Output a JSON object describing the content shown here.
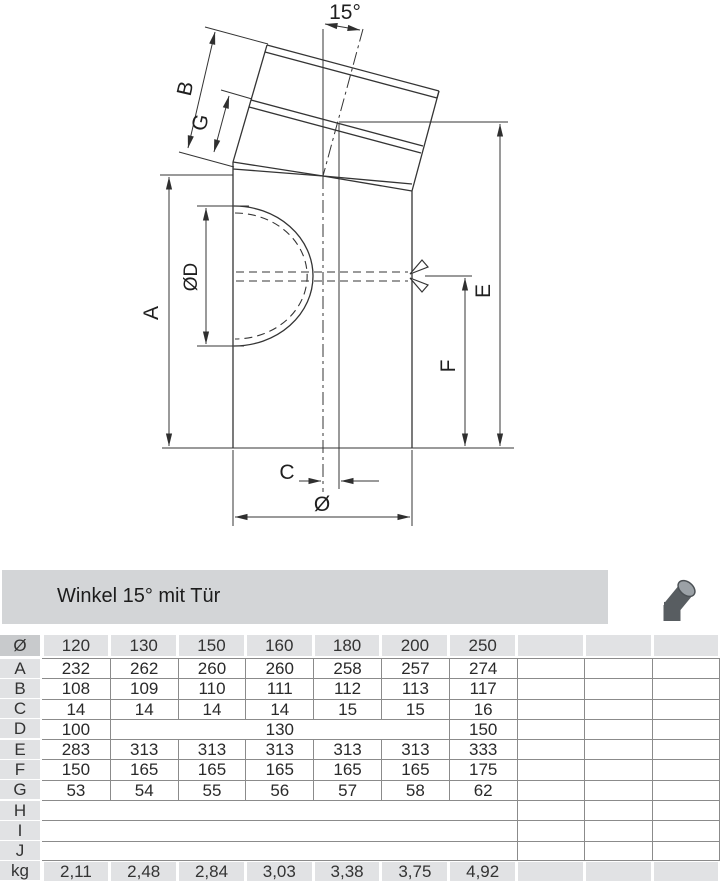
{
  "header": {
    "title": "Winkel 15° mit Tür"
  },
  "drawing": {
    "labels": {
      "angle": "15°",
      "b": "B",
      "g": "G",
      "a": "A",
      "door": "ØD",
      "e": "E",
      "f": "F",
      "c": "C",
      "dia": "Ø"
    }
  },
  "colors": {
    "line": "#343434",
    "bar_bg": "#d3d5d7",
    "chip_bg": "#e1e2e4",
    "chip_dark_bg": "#c8cacc",
    "rule": "#8b8b8b",
    "icon_body": "#585d61",
    "icon_face": "#9ba1a6"
  },
  "table": {
    "rows": [
      {
        "label": "Ø",
        "kind": "gray",
        "dark": 1,
        "cells": [
          {
            "t": "120"
          },
          {
            "t": "130"
          },
          {
            "t": "150"
          },
          {
            "t": "160"
          },
          {
            "t": "180"
          },
          {
            "t": "200"
          },
          {
            "t": "250"
          },
          {
            "t": ""
          },
          {
            "t": ""
          },
          {
            "t": ""
          }
        ]
      },
      {
        "label": "A",
        "kind": "data",
        "cells": [
          {
            "t": "232"
          },
          {
            "t": "262",
            "bl": 1
          },
          {
            "t": "260",
            "bl": 1
          },
          {
            "t": "260",
            "bl": 1
          },
          {
            "t": "258",
            "bl": 1
          },
          {
            "t": "257",
            "bl": 1
          },
          {
            "t": "274",
            "bl": 1
          },
          {
            "t": "",
            "bl": 1
          },
          {
            "t": "",
            "bl": 1
          },
          {
            "t": "",
            "bl": 1,
            "br": 1
          }
        ]
      },
      {
        "label": "B",
        "kind": "data",
        "cells": [
          {
            "t": "108"
          },
          {
            "t": "109",
            "bl": 1
          },
          {
            "t": "110",
            "bl": 1
          },
          {
            "t": "111",
            "bl": 1
          },
          {
            "t": "112",
            "bl": 1
          },
          {
            "t": "113",
            "bl": 1
          },
          {
            "t": "117",
            "bl": 1
          },
          {
            "t": "",
            "bl": 1
          },
          {
            "t": "",
            "bl": 1
          },
          {
            "t": "",
            "bl": 1,
            "br": 1
          }
        ]
      },
      {
        "label": "C",
        "kind": "data",
        "cells": [
          {
            "t": "14"
          },
          {
            "t": "14",
            "bl": 1
          },
          {
            "t": "14",
            "bl": 1
          },
          {
            "t": "14",
            "bl": 1
          },
          {
            "t": "15",
            "bl": 1
          },
          {
            "t": "15",
            "bl": 1
          },
          {
            "t": "16",
            "bl": 1
          },
          {
            "t": "",
            "bl": 1
          },
          {
            "t": "",
            "bl": 1
          },
          {
            "t": "",
            "bl": 1,
            "br": 1
          }
        ]
      },
      {
        "label": "D",
        "kind": "data",
        "cells": [
          {
            "t": "100"
          },
          {
            "t": "130",
            "s": 5,
            "bl": 1
          },
          {
            "t": "150",
            "bl": 1
          },
          {
            "t": "",
            "bl": 1
          },
          {
            "t": "",
            "bl": 1
          },
          {
            "t": "",
            "bl": 1,
            "br": 1
          }
        ]
      },
      {
        "label": "E",
        "kind": "data",
        "cells": [
          {
            "t": "283"
          },
          {
            "t": "313",
            "bl": 1
          },
          {
            "t": "313",
            "bl": 1
          },
          {
            "t": "313",
            "bl": 1
          },
          {
            "t": "313",
            "bl": 1
          },
          {
            "t": "313",
            "bl": 1
          },
          {
            "t": "333",
            "bl": 1
          },
          {
            "t": "",
            "bl": 1
          },
          {
            "t": "",
            "bl": 1
          },
          {
            "t": "",
            "bl": 1,
            "br": 1
          }
        ]
      },
      {
        "label": "F",
        "kind": "data",
        "cells": [
          {
            "t": "150"
          },
          {
            "t": "165",
            "bl": 1
          },
          {
            "t": "165",
            "bl": 1
          },
          {
            "t": "165",
            "bl": 1
          },
          {
            "t": "165",
            "bl": 1
          },
          {
            "t": "165",
            "bl": 1
          },
          {
            "t": "175",
            "bl": 1
          },
          {
            "t": "",
            "bl": 1
          },
          {
            "t": "",
            "bl": 1
          },
          {
            "t": "",
            "bl": 1,
            "br": 1
          }
        ]
      },
      {
        "label": "G",
        "kind": "data",
        "cells": [
          {
            "t": "53"
          },
          {
            "t": "54",
            "bl": 1
          },
          {
            "t": "55",
            "bl": 1
          },
          {
            "t": "56",
            "bl": 1
          },
          {
            "t": "57",
            "bl": 1
          },
          {
            "t": "58",
            "bl": 1
          },
          {
            "t": "62",
            "bl": 1
          },
          {
            "t": "",
            "bl": 1
          },
          {
            "t": "",
            "bl": 1
          },
          {
            "t": "",
            "bl": 1,
            "br": 1
          }
        ]
      },
      {
        "label": "H",
        "kind": "data",
        "cells": [
          {
            "t": "",
            "s": 7
          },
          {
            "t": "",
            "bl": 1
          },
          {
            "t": "",
            "bl": 1
          },
          {
            "t": "",
            "bl": 1,
            "br": 1
          }
        ]
      },
      {
        "label": "I",
        "kind": "data",
        "cells": [
          {
            "t": "",
            "s": 7
          },
          {
            "t": "",
            "bl": 1
          },
          {
            "t": "",
            "bl": 1
          },
          {
            "t": "",
            "bl": 1,
            "br": 1
          }
        ]
      },
      {
        "label": "J",
        "kind": "data",
        "bb": 1,
        "cells": [
          {
            "t": "",
            "s": 7
          },
          {
            "t": "",
            "bl": 1
          },
          {
            "t": "",
            "bl": 1
          },
          {
            "t": "",
            "bl": 1,
            "br": 1
          }
        ]
      },
      {
        "label": "kg",
        "kind": "gray",
        "cells": [
          {
            "t": "2,11"
          },
          {
            "t": "2,48"
          },
          {
            "t": "2,84"
          },
          {
            "t": "3,03"
          },
          {
            "t": "3,38"
          },
          {
            "t": "3,75"
          },
          {
            "t": "4,92"
          },
          {
            "t": ""
          },
          {
            "t": ""
          },
          {
            "t": ""
          }
        ]
      }
    ]
  }
}
